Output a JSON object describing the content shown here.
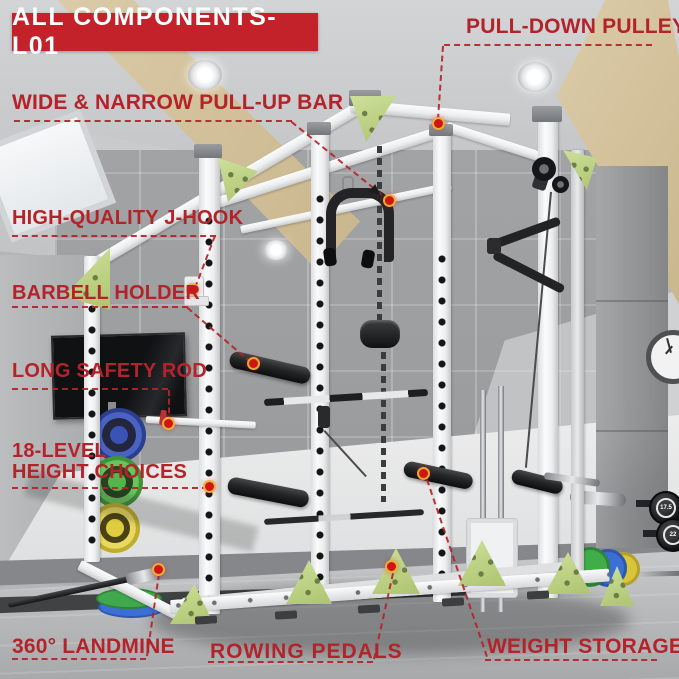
{
  "banner": {
    "label": "ALL COMPONENTS-L01"
  },
  "annotations": {
    "pull_down_pulley": "PULL-DOWN PULLEY",
    "pull_up_bar": "WIDE & NARROW PULL-UP BAR",
    "j_hook": "HIGH-QUALITY J-HOOK",
    "barbell_holder": "BARBELL HOLDER",
    "safety_rod": "LONG SAFETY ROD",
    "height_line1": "18-LEVEL",
    "height_line2": "HEIGHT CHOICES",
    "landmine": "360° LANDMINE",
    "rowing_pedals": "ROWING PEDALS",
    "weight_storage": "WEIGHT STORAGE"
  },
  "scene": {
    "kettlebell_top": "17.5",
    "kettlebell_bottom": "22"
  },
  "colors": {
    "annotation_red": "#b3242a",
    "banner_bg": "#c4222b",
    "banner_fg": "#ffffff",
    "rack_green": "#c3d98c",
    "rack_white": "#f2f3f4"
  }
}
